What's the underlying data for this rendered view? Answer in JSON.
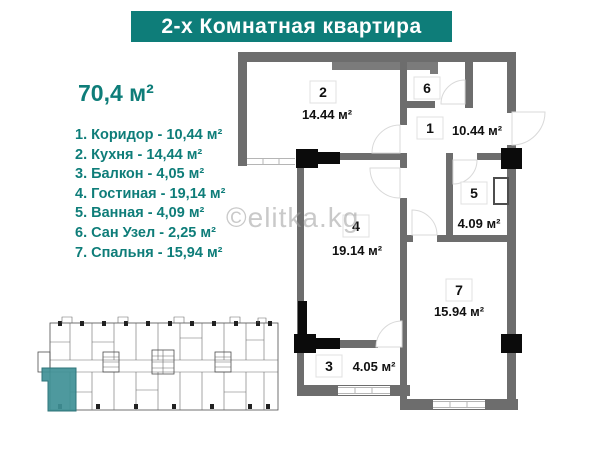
{
  "header": {
    "title": "2-х Комнатная квартира"
  },
  "apartment": {
    "total_area": "70,4 м²"
  },
  "legend": {
    "items": [
      "1. Коридор - 10,44 м²",
      "2. Кухня - 14,44 м²",
      "3. Балкон - 4,05 м²",
      "4. Гостиная - 19,14 м²",
      "5. Ванная - 4,09 м²",
      "6. Сан Узел - 2,25 м²",
      "7. Спальня - 15,94 м²"
    ]
  },
  "watermark": "©elitka.kg",
  "floor_plan": {
    "rooms": [
      {
        "number": "2",
        "area": "14.44 м²"
      },
      {
        "number": "6",
        "area": ""
      },
      {
        "number": "1",
        "area": "10.44 м²"
      },
      {
        "number": "5",
        "area": "4.09 м²"
      },
      {
        "number": "4",
        "area": "19.14 м²"
      },
      {
        "number": "7",
        "area": "15.94 м²"
      },
      {
        "number": "3",
        "area": "4.05 м²"
      }
    ]
  },
  "colors": {
    "accent_teal": "#0e7d79",
    "unit_highlight": "#3f9096",
    "wall_gray": "#6d6d6d"
  }
}
